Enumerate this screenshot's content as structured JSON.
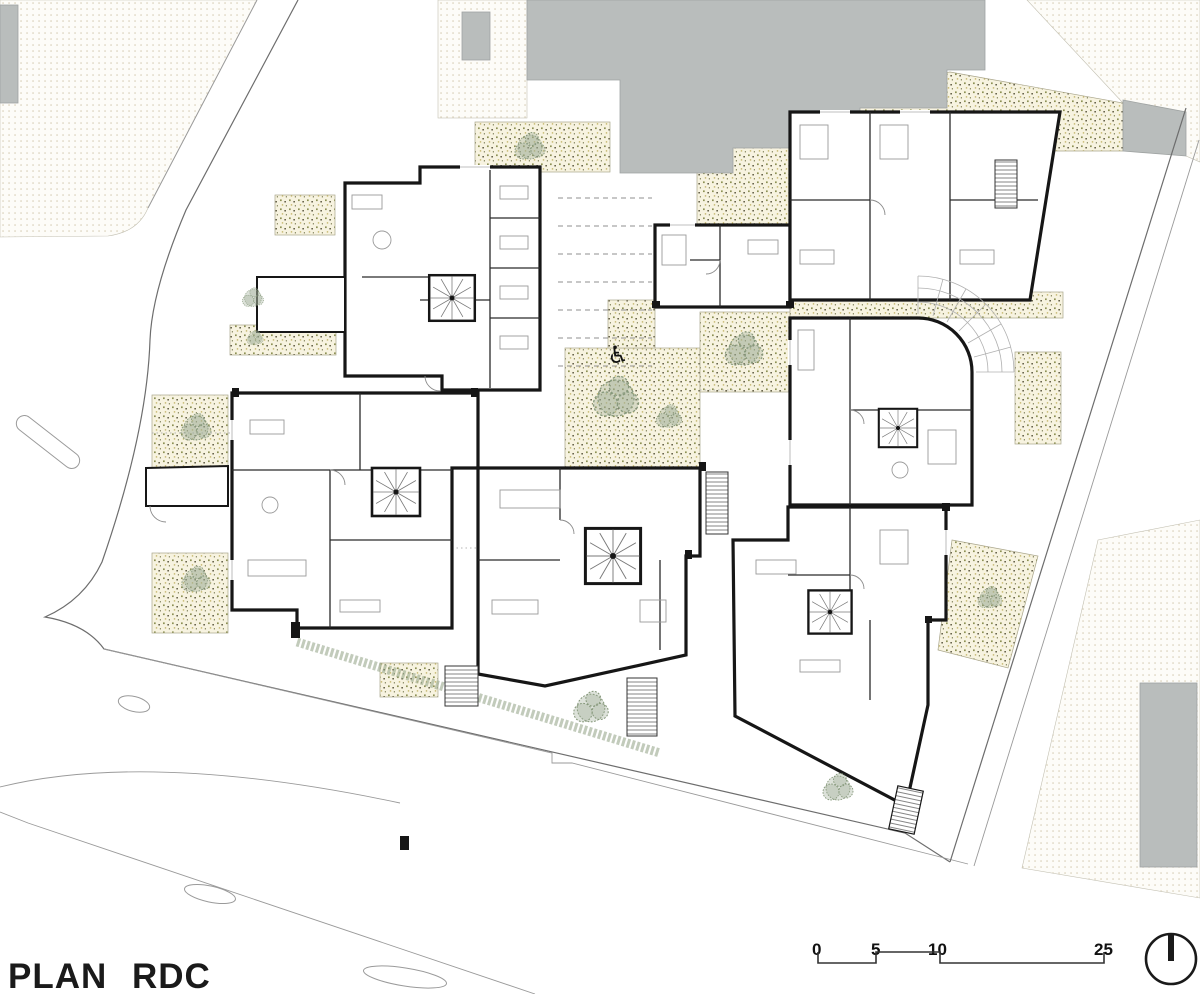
{
  "title": {
    "label": "PLAN RDC"
  },
  "scale_bar": {
    "marks": [
      "0",
      "5",
      "10",
      "25"
    ]
  },
  "symbols": {
    "accessibility": "♿"
  },
  "icons": [
    "north-arrow-icon",
    "wheelchair-icon",
    "tree-icon",
    "spiral-stair-icon"
  ],
  "colors": {
    "paper": "#ffffff",
    "wall": "#161616",
    "context_building": "#b9bdbc",
    "sidewalk_dot": "#d3c9ae",
    "garden_background": "#f7f3e0",
    "garden_dot_olive": "#8d9053",
    "garden_dot_dark": "#59553d",
    "garden_dot_ochre": "#c3b468",
    "tree_foliage": "#9ead94",
    "hedge": "#8fa184",
    "road_line": "#9a9a9a",
    "annotation_text": "#1a1a1a"
  }
}
